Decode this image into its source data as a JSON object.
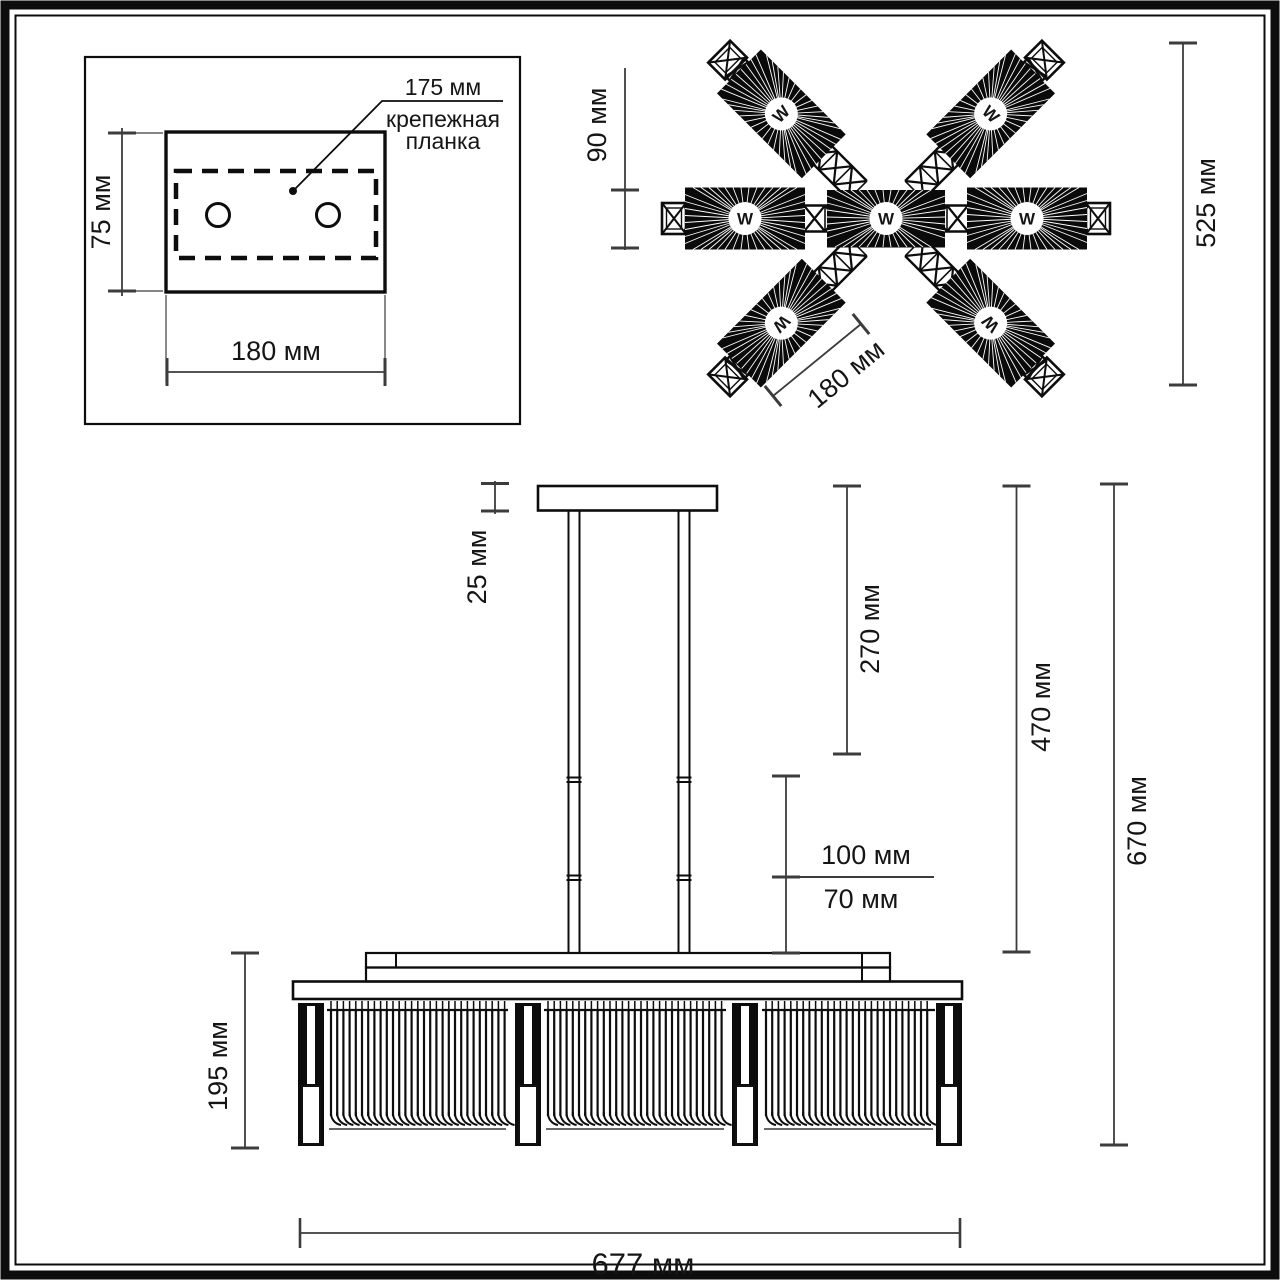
{
  "colors": {
    "ink": "#0d0d0d",
    "dim_line": "#3c3c3c",
    "bg": "#ffffff",
    "shade_fill": "#0a0a0a"
  },
  "mount": {
    "callout_value": "175 мм",
    "callout_line1": "крепежная",
    "callout_line2": "планка",
    "height": "75 мм",
    "width": "180 мм"
  },
  "top_view": {
    "shade_width": "90 мм",
    "overall": "525 мм",
    "shade_length": "180 мм",
    "lamp_mark": "W"
  },
  "side_view": {
    "canopy": "25 мм",
    "upper_rod": "270 мм",
    "to_body": "470 мм",
    "overall": "670 мм",
    "seg_a": "100 мм",
    "seg_b": "70 мм",
    "body_height": "195 мм",
    "body_width": "677 мм"
  }
}
